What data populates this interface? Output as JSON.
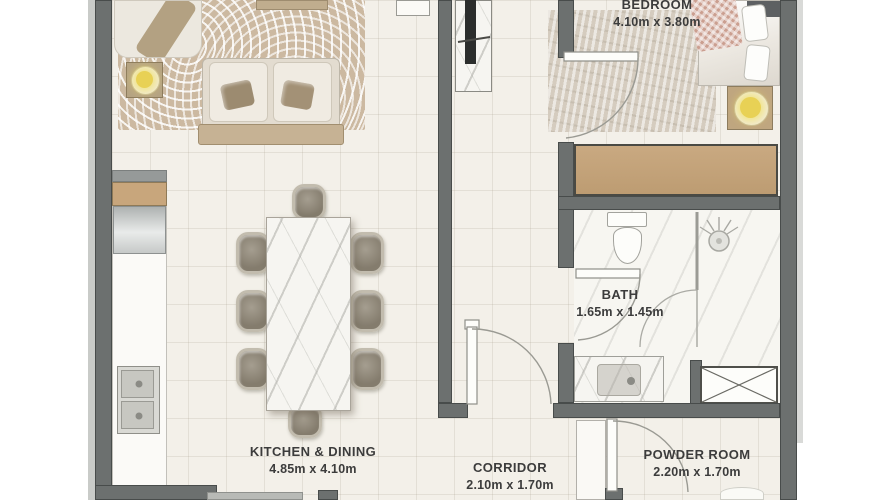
{
  "title": "Apartment floor plan",
  "rooms": {
    "bedroom": {
      "name": "BEDROOM",
      "dims": "4.10m x 3.80m"
    },
    "bath": {
      "name": "BATH",
      "dims": "1.65m x 1.45m"
    },
    "kitchen": {
      "name": "KITCHEN & DINING",
      "dims": "4.85m x 4.10m"
    },
    "corridor": {
      "name": "CORRIDOR",
      "dims": "2.10m x 1.70m"
    },
    "powder": {
      "name": "POWDER ROOM",
      "dims": "2.20m x 1.70m"
    }
  },
  "furniture_icons": [
    "sofa-icon",
    "armchair-icon",
    "coffee-table-icon",
    "floor-lamp-icon",
    "tv-unit-icon",
    "dining-table-icon",
    "dining-chair-icon",
    "kitchen-counter-icon",
    "refrigerator-icon",
    "double-sink-icon",
    "bed-icon",
    "pillow-icon",
    "nightstand-icon",
    "table-lamp-icon",
    "wardrobe-icon",
    "toilet-icon",
    "shower-icon",
    "vanity-sink-icon",
    "duct-shaft-icon",
    "door-swing-icon"
  ],
  "colors": {
    "wall": "#6c706f",
    "floor": "#f3f0e9",
    "wood_accent": "#c8a67c",
    "rug": "#ccb9a1",
    "lamp_glow": "#e8d155",
    "label_text": "#3c3c3c"
  }
}
